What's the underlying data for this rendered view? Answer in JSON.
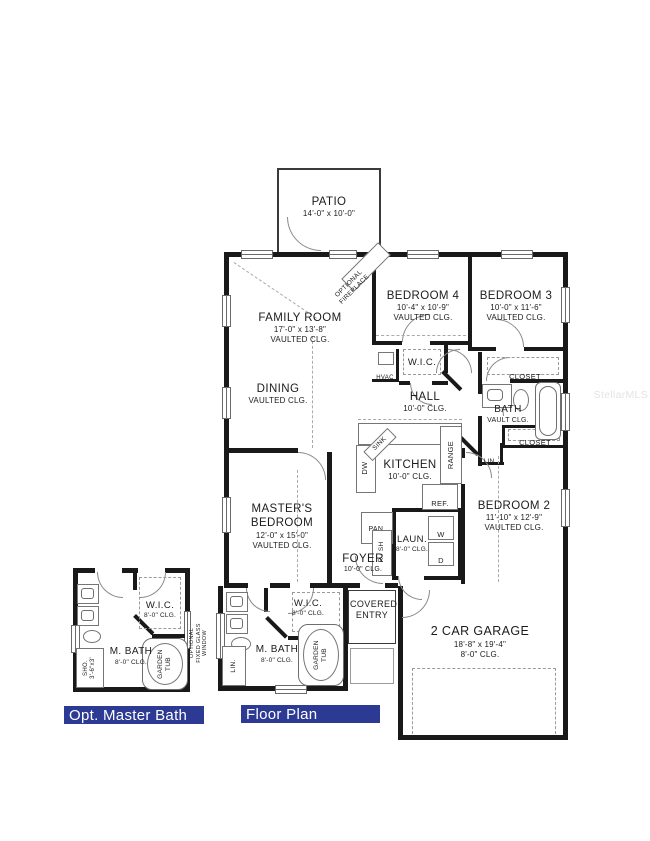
{
  "watermark": "StellarMLS",
  "banners": {
    "opt_master_bath": "Opt. Master Bath",
    "floor_plan": "Floor Plan"
  },
  "colors": {
    "wall": "#191919",
    "banner_bg": "#2d3a93",
    "banner_text": "#ffffff"
  },
  "rooms": {
    "patio": {
      "name": "PATIO",
      "dims": "14'-0\" x 10'-0\""
    },
    "family_room": {
      "name": "FAMILY ROOM",
      "dims": "17'-0\" x 13'-8\"",
      "ceiling": "VAULTED CLG."
    },
    "bedroom4": {
      "name": "BEDROOM 4",
      "dims": "10'-4\" x 10'-9\"",
      "ceiling": "VAULTED CLG."
    },
    "bedroom3": {
      "name": "BEDROOM 3",
      "dims": "10'-0\" x 11'-6\"",
      "ceiling": "VAULTED CLG."
    },
    "hall_wic": {
      "name": "W.I.C."
    },
    "hall": {
      "name": "HALL",
      "ceiling": "10'-0\" CLG."
    },
    "dining": {
      "name": "DINING",
      "ceiling": "VAULTED CLG."
    },
    "bath": {
      "name": "BATH",
      "ceiling": "VAULT CLG."
    },
    "kitchen": {
      "name": "KITCHEN",
      "ceiling": "10'-0\" CLG."
    },
    "bedroom2": {
      "name": "BEDROOM 2",
      "dims": "11'-10\" x 12'-9\"",
      "ceiling": "VAULTED CLG."
    },
    "master_bedroom": {
      "name": "MASTER'S BEDROOM",
      "dims": "12'-0\" x 15'-0\"",
      "ceiling": "VAULTED CLG."
    },
    "laundry": {
      "name": "LAUN.",
      "ceiling": "8'-0\" CLG."
    },
    "foyer": {
      "name": "FOYER",
      "ceiling": "10'-0\" CLG."
    },
    "covered_entry": {
      "name": "COVERED ENTRY"
    },
    "garage": {
      "name": "2 CAR GARAGE",
      "dims": "18'-8\" x 19'-4\"",
      "ceiling": "8'-0\" CLG."
    },
    "master_wic": {
      "name": "W.I.C.",
      "ceiling": "8'-0\" CLG."
    },
    "master_bath": {
      "name": "M. BATH",
      "ceiling": "8'-0\" CLG."
    },
    "opt_wic": {
      "name": "W.I.C.",
      "ceiling": "8'-0\" CLG."
    },
    "opt_master_bath": {
      "name": "M. BATH",
      "ceiling": "8'-0\" CLG."
    }
  },
  "fixtures": {
    "optional_fireplace": "OPTIONAL FIREPLACE",
    "hvac": "HVAC",
    "closet_top": "CLOSET",
    "closet_bottom": "CLOSET",
    "linen_hall": "LIN.",
    "sink": "SINK",
    "dishwasher": "DW",
    "range": "RANGE",
    "refrigerator": "REF.",
    "pantry": "PAN.",
    "rod_shelf": "R / SH",
    "washer": "W",
    "dryer": "D",
    "garden_tub": "GARDEN TUB",
    "linen_master": "LIN.",
    "optional_window_note": "OPTIONAL FIXED GLASS WINDOW",
    "shower": "SHO.",
    "shower_dims": "3'-6\"x3'"
  }
}
